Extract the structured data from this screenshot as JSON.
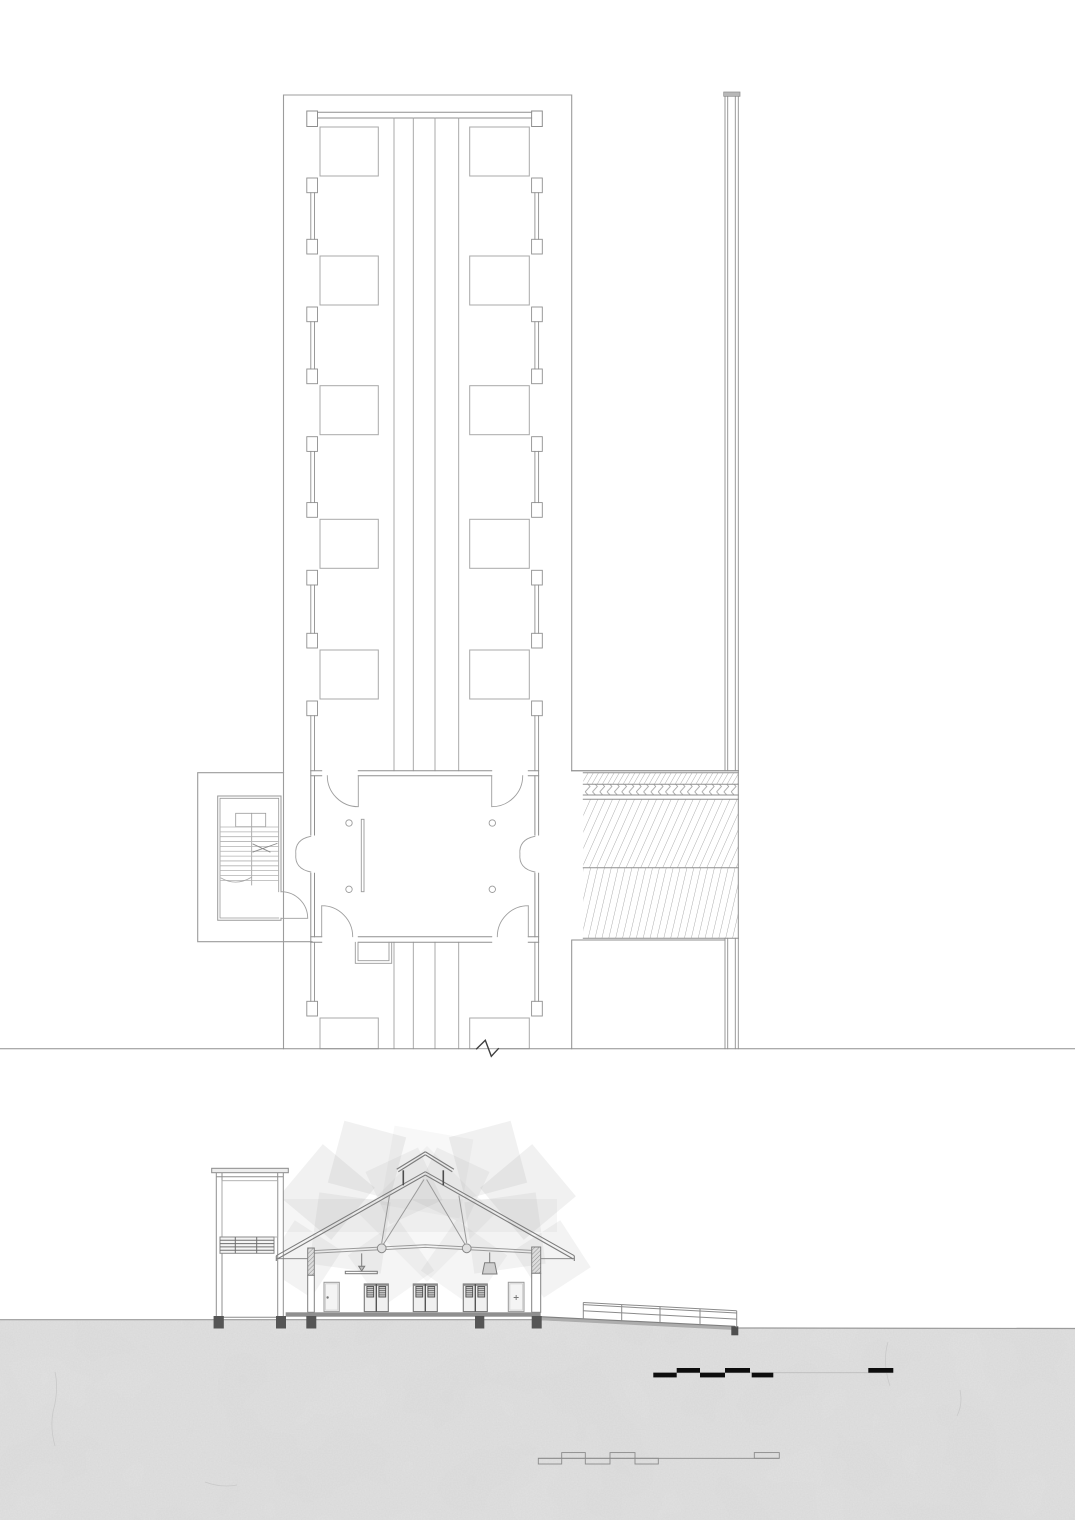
{
  "document": {
    "title": "architectural-drawing-sheet",
    "drawings": [
      "roof-plan",
      "cross-section"
    ],
    "colors": {
      "paper": "#ffffff",
      "line_light": "#a8a8a8",
      "line_mid": "#8f8f8f",
      "line_dark": "#4f4f4f",
      "black": "#0d0d0d",
      "cut_fill": "#8f8f8f",
      "terrain_base": "#e2e2e2",
      "watermark": "#8f8f8f"
    }
  },
  "plan": {
    "outer": {
      "left": 283.5,
      "top": 95,
      "right": 571.7,
      "bottom": 1048.7
    },
    "corridor": {
      "xs": [
        394,
        413.3,
        435,
        458.7
      ],
      "segments": [
        [
          118,
          770.7
        ],
        [
          942.3,
          1048.7
        ]
      ]
    },
    "stalls": {
      "row_tops": [
        127,
        256,
        385.7,
        519.3,
        650,
        1018
      ],
      "height": 49,
      "clip_bottom": 1048.7,
      "left": {
        "x": 320,
        "w": 58.3
      },
      "right": {
        "x": 469.7,
        "w": 59.6
      }
    },
    "pilasters": {
      "block_h": 14.7,
      "left": {
        "block_x": 306.8,
        "block_w": 10.7,
        "wall_x": [
          310.8,
          314.5
        ]
      },
      "right": {
        "block_x": 531.6,
        "block_w": 10.7,
        "wall_x": [
          534.9,
          538.6
        ]
      },
      "gaps": [
        {
          "y0": 176,
          "y1": 256,
          "tb": true,
          "bb": true
        },
        {
          "y0": 305,
          "y1": 385.7,
          "tb": true,
          "bb": true
        },
        {
          "y0": 434.7,
          "y1": 519.3,
          "tb": true,
          "bb": true
        },
        {
          "y0": 568.3,
          "y1": 650,
          "tb": true,
          "bb": true
        },
        {
          "y0": 699,
          "y1": 770.7,
          "tb": true,
          "bb": false
        },
        {
          "y0": 942.3,
          "y1": 1018,
          "tb": false,
          "bb": true
        }
      ]
    },
    "stair": {
      "tread_y0": 827,
      "tread_step": 4.85,
      "tread_count": 12,
      "left_x": [
        220,
        251.7
      ],
      "right_x": [
        251.7,
        278.7
      ]
    },
    "hatch": {
      "x0": 583.3,
      "x1": 738.3,
      "lines_y": [
        770.7,
        772.7,
        784.3,
        795,
        799.3,
        867.7,
        938.3
      ],
      "bands": [
        {
          "y0": 772.7,
          "y1": 784.3,
          "fill": "hatch60"
        },
        {
          "y0": 784.3,
          "y1": 795,
          "fill": "herring"
        },
        {
          "y0": 799.3,
          "y1": 867.7,
          "fill": "hatch67"
        },
        {
          "y0": 867.7,
          "y1": 938.3,
          "fill": "hatch77"
        }
      ]
    },
    "fence": {
      "xs": [
        725,
        727.7,
        735.3,
        738.3
      ],
      "segments": [
        [
          96.3,
          770.7
        ],
        [
          938.3,
          1048.7
        ]
      ],
      "cap": {
        "x": 723.7,
        "y": 92,
        "w": 16.3,
        "h": 4.3
      }
    },
    "break_line": {
      "y": 1048.7,
      "zig": [
        476.7,
        485.3,
        491.3,
        498.3
      ]
    }
  },
  "section": {
    "watermark": {
      "shapes": [
        {
          "cx": 367,
          "cy": 1160,
          "s": 64,
          "rot": 15,
          "o": 0.13
        },
        {
          "cx": 327,
          "cy": 1192,
          "s": 68,
          "rot": 40,
          "o": 0.13
        },
        {
          "cx": 404,
          "cy": 1186,
          "s": 58,
          "rot": 65,
          "o": 0.1
        },
        {
          "cx": 350,
          "cy": 1233,
          "s": 72,
          "rot": 8,
          "o": 0.11
        },
        {
          "cx": 303,
          "cy": 1259,
          "s": 56,
          "rot": 33,
          "o": 0.11
        },
        {
          "cx": 391,
          "cy": 1263,
          "s": 62,
          "rot": 55,
          "o": 0.09
        },
        {
          "cx": 488,
          "cy": 1160,
          "s": 64,
          "rot": 75,
          "o": 0.13
        },
        {
          "cx": 528,
          "cy": 1192,
          "s": 68,
          "rot": 50,
          "o": 0.13
        },
        {
          "cx": 451,
          "cy": 1186,
          "s": 58,
          "rot": 25,
          "o": 0.1
        },
        {
          "cx": 505,
          "cy": 1233,
          "s": 72,
          "rot": 82,
          "o": 0.11
        },
        {
          "cx": 552,
          "cy": 1259,
          "s": 56,
          "rot": 57,
          "o": 0.11
        },
        {
          "cx": 464,
          "cy": 1263,
          "s": 62,
          "rot": 35,
          "o": 0.09
        },
        {
          "cx": 427,
          "cy": 1214,
          "s": 96,
          "rot": 45,
          "o": 0.07
        },
        {
          "cx": 427,
          "cy": 1172,
          "s": 80,
          "rot": 10,
          "o": 0.06
        }
      ],
      "band": {
        "x": 263,
        "y": 1199,
        "w": 294,
        "h": 33,
        "o": 0.08
      }
    },
    "doors": {
      "units": [
        {
          "type": "single",
          "x": 324,
          "w": 15.3,
          "mark": "dot"
        },
        {
          "type": "pair",
          "x": 364.3,
          "w": 24
        },
        {
          "type": "pair",
          "x": 413.3,
          "w": 24
        },
        {
          "type": "pair",
          "x": 463.3,
          "w": 24
        },
        {
          "type": "single",
          "x": 508.3,
          "w": 15.7,
          "mark": "cross"
        }
      ],
      "single_top": 1282.3,
      "pair_top": 1284,
      "bottom": 1311.6
    },
    "railing": {
      "posts_x": [
        583.3,
        621.7,
        660,
        700,
        736.7
      ],
      "base": {
        "x0": 543,
        "y0": 1316.8,
        "x1": 735,
        "y1": 1327.2
      },
      "post_h": 16.5,
      "mid_offset": 8.3
    },
    "footings": [
      [
        213.7,
        1316,
        10,
        12.5
      ],
      [
        276,
        1316,
        10,
        12.5
      ],
      [
        306.3,
        1316,
        10,
        12.5
      ],
      [
        475,
        1316,
        9.3,
        12.5
      ],
      [
        531.7,
        1316,
        10,
        12.5
      ]
    ],
    "scalebars": [
      {
        "style": "filled",
        "line_y": 1372.7,
        "line_x": [
          653.3,
          893.3
        ],
        "seg_h": 4.7,
        "above": [
          [
            676.7,
            700
          ],
          [
            725,
            750
          ],
          [
            868.3,
            893.3
          ]
        ],
        "below": [
          [
            653.3,
            676.7
          ],
          [
            700,
            725
          ],
          [
            751.7,
            773.3
          ]
        ]
      },
      {
        "style": "outline",
        "line_y": 1458.3,
        "line_x": [
          538.3,
          779.3
        ],
        "seg_h": 5.7,
        "above": [
          [
            561.7,
            585.3
          ],
          [
            610,
            635
          ],
          [
            754.3,
            779.3
          ]
        ],
        "below": [
          [
            538.3,
            561.7
          ],
          [
            585.3,
            610
          ],
          [
            635,
            658.3
          ]
        ]
      }
    ],
    "terrain": {
      "surface": [
        [
          0,
          1319.7
        ],
        [
          543,
          1319.7
        ],
        [
          738,
          1328
        ],
        [
          1075,
          1328.5
        ]
      ],
      "bottom": 1520
    }
  }
}
